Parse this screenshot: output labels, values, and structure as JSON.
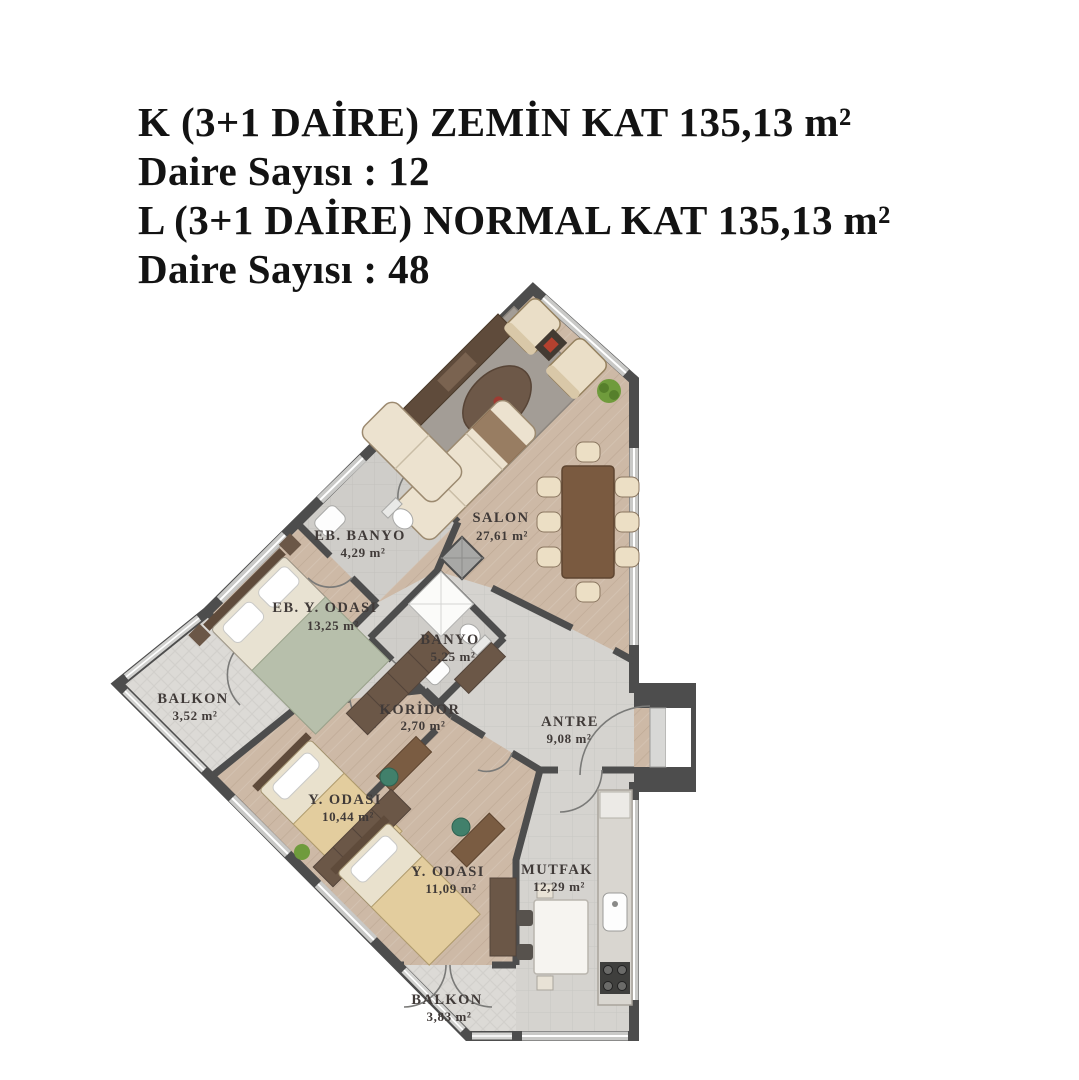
{
  "header": {
    "lines": [
      "K (3+1 DAİRE) ZEMİN KAT 135,13 m²",
      "Daire Sayısı : 12",
      "L (3+1 DAİRE) NORMAL KAT 135,13 m²",
      "Daire Sayısı : 48"
    ]
  },
  "floorplan": {
    "rooms": [
      {
        "id": "salon",
        "name": "SALON",
        "area": "27,61 m²"
      },
      {
        "id": "eb-banyo",
        "name": "EB. BANYO",
        "area": "4,29 m²"
      },
      {
        "id": "eb-y-odasi",
        "name": "EB. Y. ODASI",
        "area": "13,25 m²"
      },
      {
        "id": "banyo",
        "name": "BANYO",
        "area": "5,25 m²"
      },
      {
        "id": "koridor",
        "name": "KORİDOR",
        "area": "2,70 m²"
      },
      {
        "id": "antre",
        "name": "ANTRE",
        "area": "9,08 m²"
      },
      {
        "id": "balkon-yan",
        "name": "BALKON",
        "area": "3,52 m²"
      },
      {
        "id": "y-odasi-1",
        "name": "Y. ODASI",
        "area": "10,44 m²"
      },
      {
        "id": "y-odasi-2",
        "name": "Y. ODASI",
        "area": "11,09 m²"
      },
      {
        "id": "mutfak",
        "name": "MUTFAK",
        "area": "12,29 m²"
      },
      {
        "id": "balkon-alt",
        "name": "BALKON",
        "area": "3,83 m²"
      }
    ],
    "colors": {
      "wall": "#4d4d4d",
      "wood_floor": "#cdb9a6",
      "tile_floor": "#d5d3cf",
      "balcony_floor": "#dcdad6",
      "window": "#c9c9c7",
      "label_text": "#403a38"
    }
  }
}
